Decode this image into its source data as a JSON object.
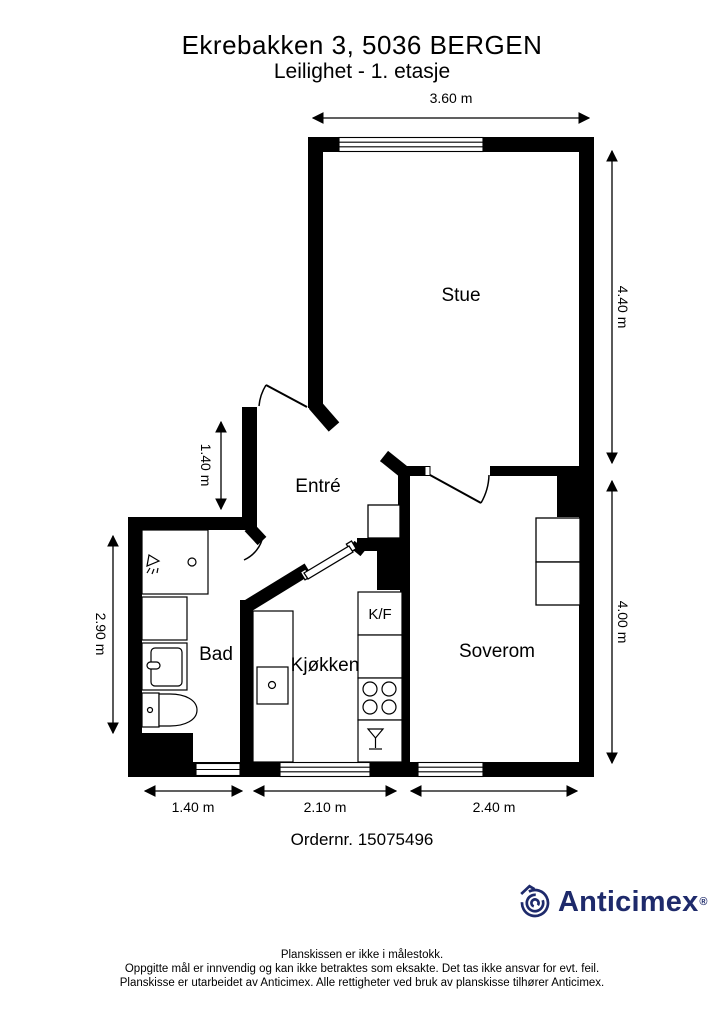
{
  "header": {
    "title": "Ekrebakken 3, 5036 BERGEN",
    "subtitle": "Leilighet - 1. etasje"
  },
  "rooms": {
    "stue": "Stue",
    "entre": "Entré",
    "bad": "Bad",
    "kjokken": "Kjøkken",
    "soverom": "Soverom",
    "kf": "K/F"
  },
  "dimensions": {
    "top_width": "3.60 m",
    "right_upper": "4.40 m",
    "right_lower": "4.00 m",
    "left_entre": "1.40 m",
    "left_bad": "2.90 m",
    "bottom_bad": "1.40 m",
    "bottom_kitchen": "2.10 m",
    "bottom_bedroom": "2.40 m"
  },
  "order": {
    "number_label": "Ordernr. 15075496"
  },
  "logo": {
    "text": "Anticimex",
    "registered": "®",
    "color": "#1e2a6b"
  },
  "footer": {
    "line1": "Planskissen er ikke i målestokk.",
    "line2": "Oppgitte mål er innvendig og kan ikke betraktes som eksakte. Det tas ikke ansvar for evt. feil.",
    "line3": "Planskisse er utarbeidet av Anticimex. Alle rettigheter ved bruk av planskisse tilhører Anticimex."
  }
}
